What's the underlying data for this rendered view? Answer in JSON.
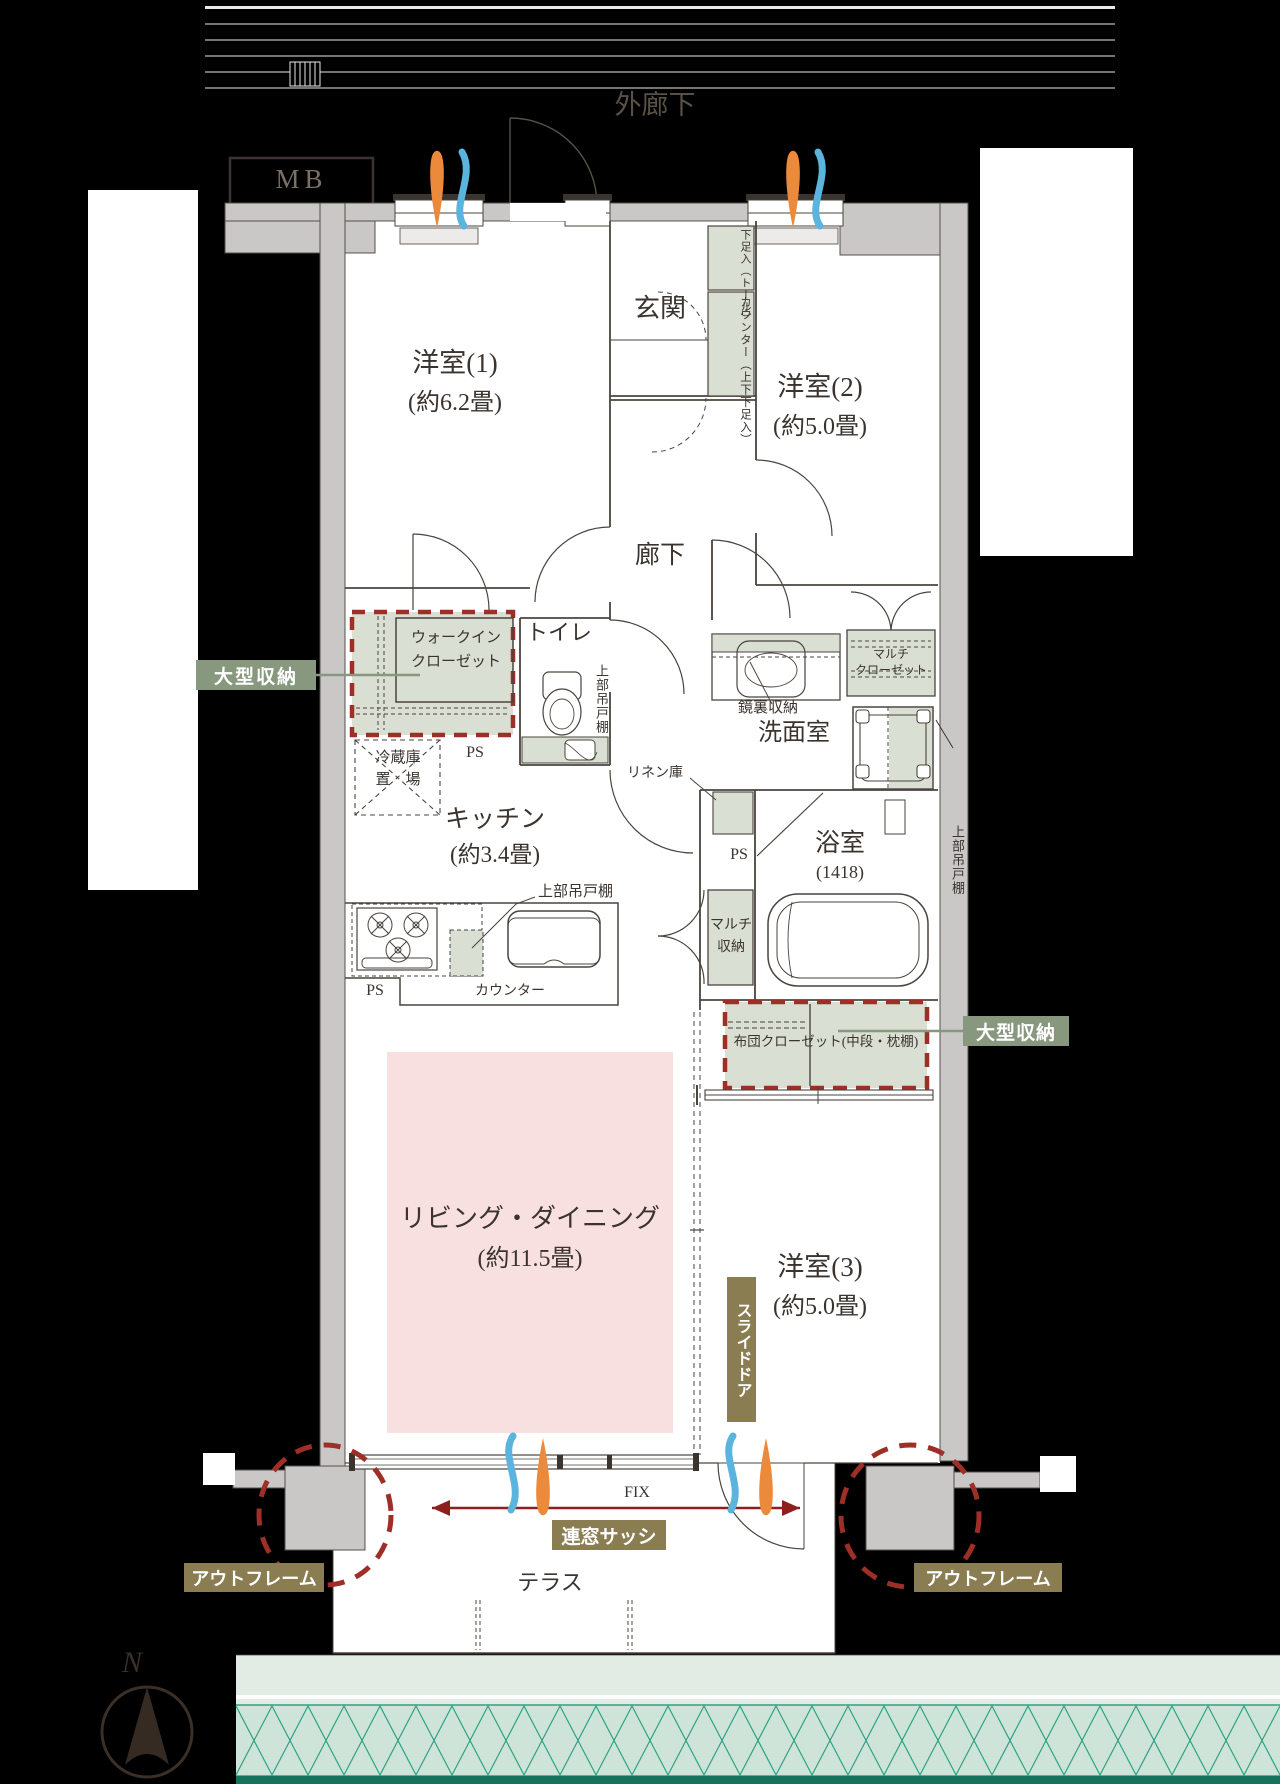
{
  "plan_title": "3LDK apartment floor plan",
  "site": {
    "outer_corridor": "外廊下",
    "meter_box": "MB",
    "terrace": "テラス",
    "compass_north": "N"
  },
  "rooms": {
    "room1": {
      "name": "洋室(1)",
      "size": "(約6.2畳)"
    },
    "room2": {
      "name": "洋室(2)",
      "size": "(約5.0畳)"
    },
    "room3": {
      "name": "洋室(3)",
      "size": "(約5.0畳)"
    },
    "living": {
      "name": "リビング・ダイニング",
      "size": "(約11.5畳)"
    },
    "kitchen": {
      "name": "キッチン",
      "size": "(約3.4畳)"
    },
    "entrance": {
      "name": "玄関"
    },
    "hallway": {
      "name": "廊下"
    },
    "toilet": {
      "name": "トイレ"
    },
    "washroom": {
      "name": "洗面室"
    },
    "bathroom": {
      "name": "浴室",
      "size": "(1418)"
    }
  },
  "fixtures": {
    "ps": "PS",
    "fix_window": "FIX",
    "counter": "カウンター",
    "upper_cabinet": "上部吊戸棚",
    "fridge_line1": "冷蔵庫",
    "fridge_line2": "置　場",
    "linen": "リネン庫",
    "mirror_storage": "鏡裏収納",
    "multi_closet_line1": "マルチ",
    "multi_closet_line2": "クローゼット",
    "multi_storage_line1": "マルチ",
    "multi_storage_line2": "収納",
    "walkin_line1": "ウォークイン",
    "walkin_line2": "クローゼット",
    "futon_closet": "布団クローゼット(中段・枕棚)",
    "shoe_tall": "下足入（トール）",
    "shoe_counter": "カウンター（上下下足入）"
  },
  "callouts": {
    "large_storage": "大型収納",
    "out_frame": "アウトフレーム",
    "multi_sash": "連窓サッシ",
    "slide_door": "スライドドア"
  },
  "colors": {
    "background": "#000000",
    "wall_gray": "#c9c8c6",
    "line_dark": "#4a443e",
    "storage_green": "#d9dfd2",
    "badge_green": "#87987e",
    "badge_olive": "#8a7d52",
    "accent_red_dash": "#9d2f27",
    "arrow_red": "#8e1f1f",
    "living_pink": "#f8e0e1",
    "vent_orange": "#ec8a3c",
    "vent_blue": "#5ab4dd",
    "planting_teal": "#2aa183",
    "planting_fill": "#cfe4d9"
  }
}
